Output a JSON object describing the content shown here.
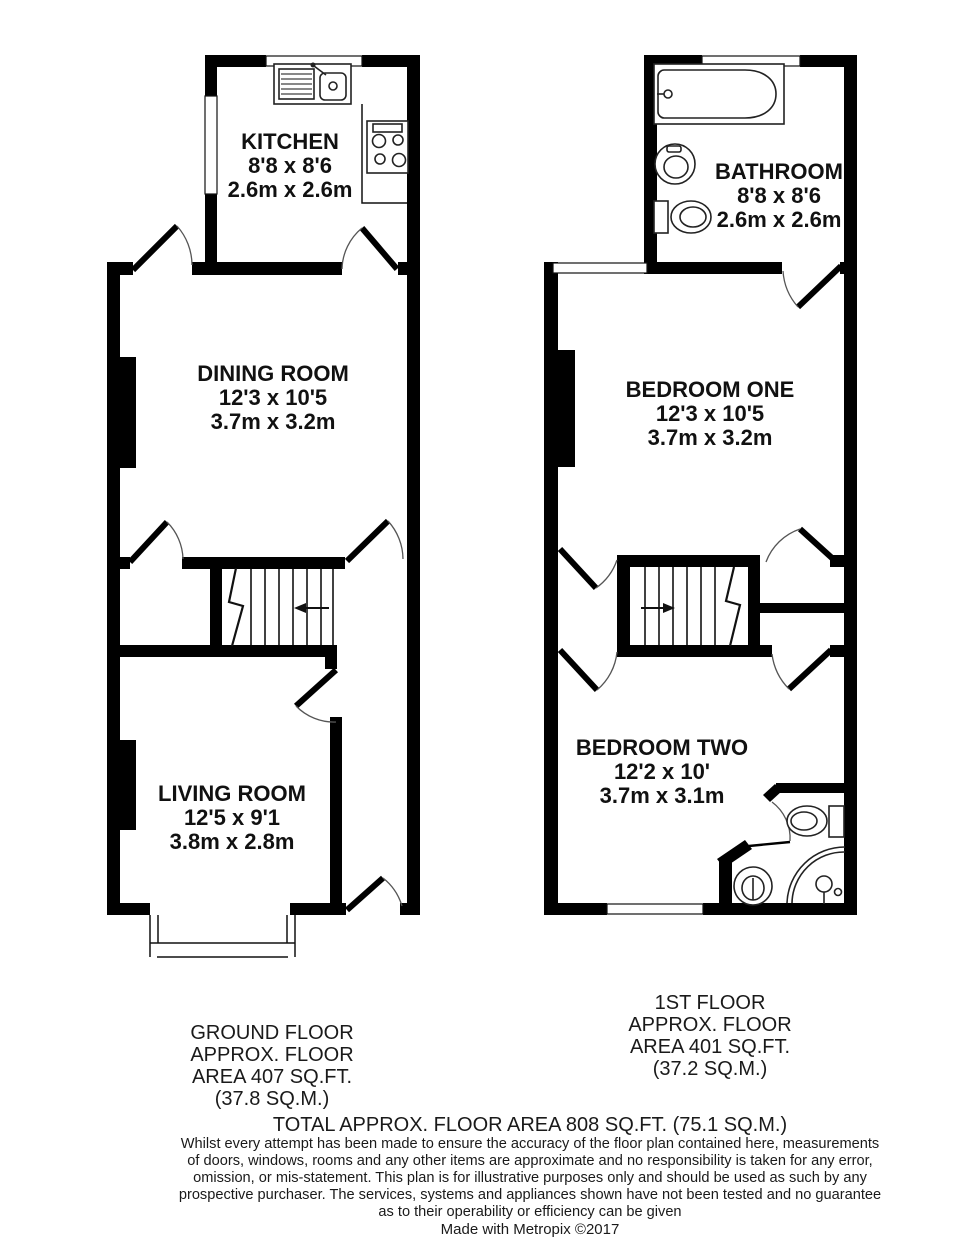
{
  "title": "Floor Plan",
  "colors": {
    "wall": "#000000",
    "background": "#ffffff",
    "text": "#111111"
  },
  "floors": {
    "ground": {
      "label_lines": [
        "GROUND FLOOR",
        "APPROX. FLOOR",
        "AREA 407 SQ.FT.",
        "(37.8 SQ.M.)"
      ],
      "rooms": {
        "kitchen": {
          "name": "KITCHEN",
          "imperial": "8'8 x 8'6",
          "metric": "2.6m x 2.6m"
        },
        "dining": {
          "name": "DINING ROOM",
          "imperial": "12'3 x 10'5",
          "metric": "3.7m x 3.2m"
        },
        "living": {
          "name": "LIVING ROOM",
          "imperial": "12'5 x 9'1",
          "metric": "3.8m x 2.8m"
        }
      }
    },
    "first": {
      "label_lines": [
        "1ST FLOOR",
        "APPROX. FLOOR",
        "AREA 401 SQ.FT.",
        "(37.2 SQ.M.)"
      ],
      "rooms": {
        "bathroom": {
          "name": "BATHROOM",
          "imperial": "8'8 x 8'6",
          "metric": "2.6m x 2.6m"
        },
        "bedroom_one": {
          "name": "BEDROOM ONE",
          "imperial": "12'3 x 10'5",
          "metric": "3.7m x 3.2m"
        },
        "bedroom_two": {
          "name": "BEDROOM TWO",
          "imperial": "12'2 x 10'",
          "metric": "3.7m x 3.1m"
        }
      }
    }
  },
  "footer": {
    "total": "TOTAL APPROX. FLOOR AREA 808 SQ.FT. (75.1 SQ.M.)",
    "disclaimer_lines": [
      "Whilst every attempt has been made to ensure the accuracy of the floor plan contained here, measurements",
      "of doors, windows, rooms and any other items are approximate and no responsibility is taken for any error,",
      "omission, or mis-statement. This plan is for illustrative purposes only and should be used as such by any",
      "prospective purchaser. The services, systems and appliances shown have not been tested and no guarantee",
      "as to their operability or efficiency can be given"
    ],
    "credit": "Made with Metropix ©2017"
  }
}
